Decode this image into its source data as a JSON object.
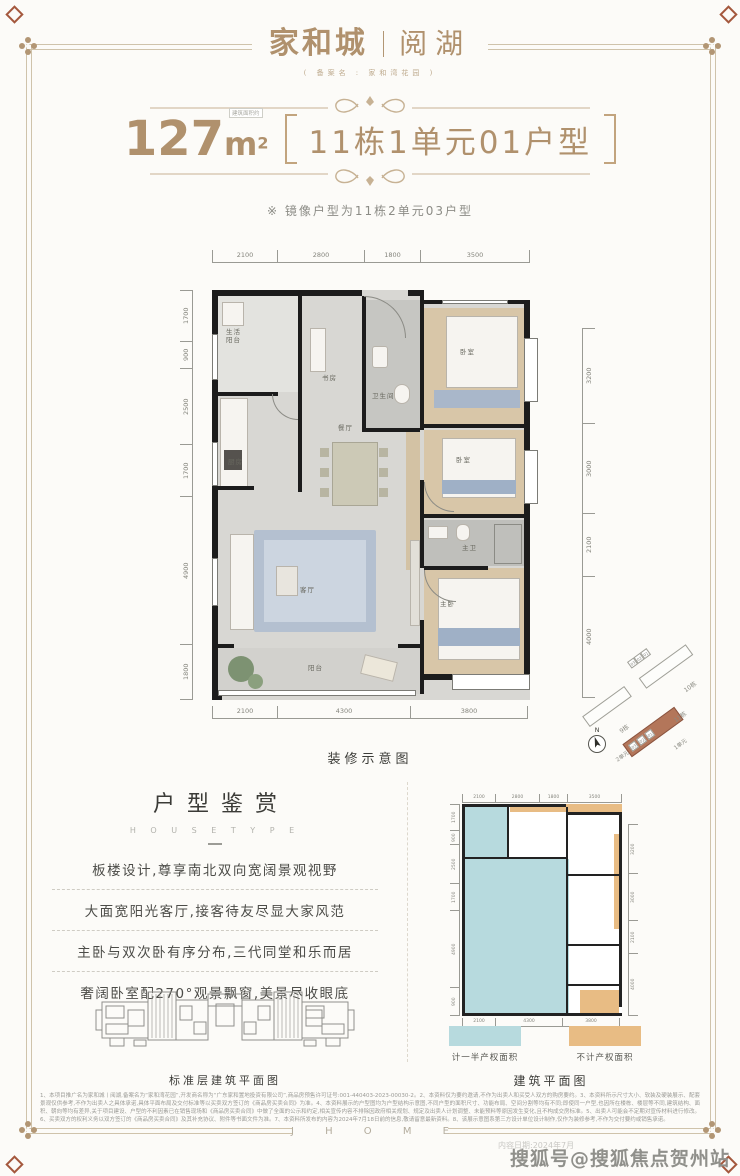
{
  "page": {
    "bg": "#fcfbf8",
    "accent": "#b0916d",
    "frame_color": "#cfc3ab"
  },
  "watermark": {
    "text": "搜狐号@搜狐焦点贺州站",
    "date_note": "内容日期:2024年7月"
  },
  "header": {
    "logo_main": "家和城",
    "logo_sub": "阅湖",
    "record_name": "( 备案名 : 家和湾花园 )"
  },
  "title": {
    "area_number": "127",
    "area_unit": "m",
    "area_sup": "2",
    "area_tag": "建筑面积约",
    "block_label": "11栋1单元01户型"
  },
  "mirror_note": "※ 镜像户型为11栋2单元03户型",
  "floorplan": {
    "caption": "装修示意图",
    "dims_top": [
      "2100",
      "2800",
      "1800",
      "3500"
    ],
    "dims_bottom": [
      "2100",
      "4300",
      "3800"
    ],
    "dims_left": [
      "1700",
      "900",
      "2500",
      "1700",
      "4900",
      "1800"
    ],
    "dims_right": [
      "3200",
      "3000",
      "2100",
      "4000"
    ],
    "rooms": [
      "生活阳台",
      "厨房",
      "书房",
      "卫生间",
      "卧室",
      "餐厅",
      "卧室",
      "主卫",
      "客厅",
      "主卧",
      "阳台"
    ]
  },
  "sitemap": {
    "compass": "N",
    "buildings": [
      "9栋",
      "10栋",
      "11栋"
    ],
    "units": [
      "2单元",
      "1单元"
    ],
    "unit_chips": [
      "03",
      "02",
      "01"
    ],
    "highlight_color": "#b3765a"
  },
  "appreciation": {
    "title": "户型鉴赏",
    "subtitle": "H O U S E   T Y P E",
    "points": [
      "板楼设计,尊享南北双向宽阔景观视野",
      "大面宽阳光客厅,接客待友尽显大家风范",
      "主卧与双次卧有序分布,三代同堂和乐而居",
      "奢阔卧室配270°观景飘窗,美景尽收眼底"
    ],
    "floorplate_caption": "标准层建筑平面图"
  },
  "construction": {
    "caption": "建筑平面图",
    "legend": [
      {
        "label": "计一半产权面积",
        "color": "#b7dade"
      },
      {
        "label": "不计产权面积",
        "color": "#e8bc84"
      }
    ],
    "dims_top": [
      "2100",
      "2800",
      "1800",
      "3500"
    ],
    "dims_bottom": [
      "2100",
      "4300",
      "3800"
    ],
    "dims_left": [
      "1700",
      "900",
      "2500",
      "1700",
      "4900",
      "900"
    ],
    "dims_right": [
      "3200",
      "3000",
      "2100",
      "4000"
    ]
  },
  "footer": {
    "brand": "J H O M E"
  },
  "disclaimer": "1、本项目推广名为家和城丨阅湖,备案名为“家和湾花园”,开发商名称为“广东家和置地投资有限公司”,商品房预售许可证号:001-440403-2023-00030-2。2、本资料仅为要约邀请,不作为出卖人和买受人双方的购房要约。3、本资料所示尺寸大小、软装及硬装展示、配套景观仅供参考,不作为出卖人之具体承诺,具体平面布局及交付标准等以买卖双方签订的《商品房买卖合同》为准。4、本资料展示的户型图均为户型结构示意图,不同户型的面积尺寸、功能布局、空间分割等均有不同;即使同一户型,也因所在楼栋、楼层等不同,建筑结构、面积、朝向等均有差异,关于项目建设、户型的不利因素已在销售现场和《商品房买卖合同》中做了全面的公示和约定,相关宣传内容不排除因政府相关规划、规定及出卖人计划调整、未能预料等原因发生变化,且不构成交房标准。5、出卖人可能会不定期对宣传材料进行修改。6、买卖双方的权利义务以双方签订的《商品房买卖合同》及其补充协议、附件等书面文件为准。7、本资料所发布的内容为2024年7月18日前的信息,敬请留意最新资料。8、该展示意图系第三方设计单位设计制作,仅作为装修参考,不作为交付要约或销售承诺。"
}
